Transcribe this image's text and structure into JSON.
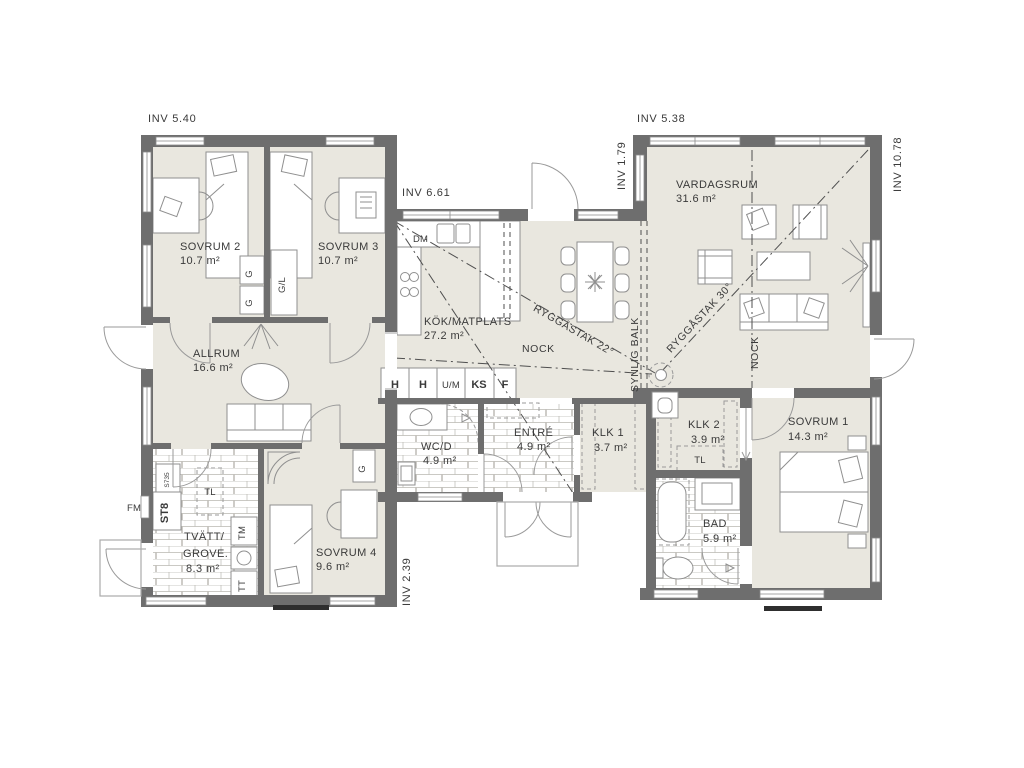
{
  "title": "single-storey house floor plan",
  "colors": {
    "wall": "#6e6e6e",
    "floor": "#e9e7df",
    "line": "#8f8f8f",
    "text": "#3a3a3a"
  },
  "dims": {
    "top_left": "INV 5.40",
    "kitchen": "INV 6.61",
    "top_right": "INV 5.38",
    "wing_left": "INV 1.79",
    "right": "INV 10.78",
    "bottom": "INV 2.39"
  },
  "rooms": {
    "sovrum2": {
      "name": "SOVRUM 2",
      "area": "10.7 m²"
    },
    "sovrum3": {
      "name": "SOVRUM 3",
      "area": "10.7 m²"
    },
    "allrum": {
      "name": "ALLRUM",
      "area": "16.6 m²"
    },
    "kok": {
      "name": "KÖK/MATPLATS",
      "area": "27.2 m²"
    },
    "vardagsrum": {
      "name": "VARDAGSRUM",
      "area": "31.6 m²"
    },
    "tvatt": {
      "name": "TVÄTT/",
      "name2": "GROVE.",
      "area": "8.3 m²"
    },
    "sovrum4": {
      "name": "SOVRUM 4",
      "area": "9.6 m²"
    },
    "wcd": {
      "name": "WC/D",
      "area": "4.9 m²"
    },
    "entre": {
      "name": "ENTRÉ",
      "area": "4.9 m²"
    },
    "klk1": {
      "name": "KLK 1",
      "area": "3.7 m²"
    },
    "klk2": {
      "name": "KLK 2",
      "area": "3.9 m²"
    },
    "bad": {
      "name": "BAD",
      "area": "5.9 m²"
    },
    "sovrum1": {
      "name": "SOVRUM 1",
      "area": "14.3 m²"
    }
  },
  "roof": {
    "ridge22": "RYGGÅSTAK 22°",
    "ridge30": "RYGGÅSTAK 30°",
    "nock_kitchen": "NOCK",
    "nock_living": "NOCK",
    "beam": "SYNLIG BALK"
  },
  "fixtures": {
    "dm": "DM",
    "fm": "FM",
    "h1": "H",
    "h2": "H",
    "um": "U/M",
    "ks": "KS",
    "f": "F",
    "g1": "G",
    "g2": "G",
    "gl": "G/L",
    "g4": "G",
    "s735": "S735",
    "st8": "ST8",
    "tl1": "TL",
    "tm": "TM",
    "tt": "TT",
    "tl2": "TL"
  }
}
